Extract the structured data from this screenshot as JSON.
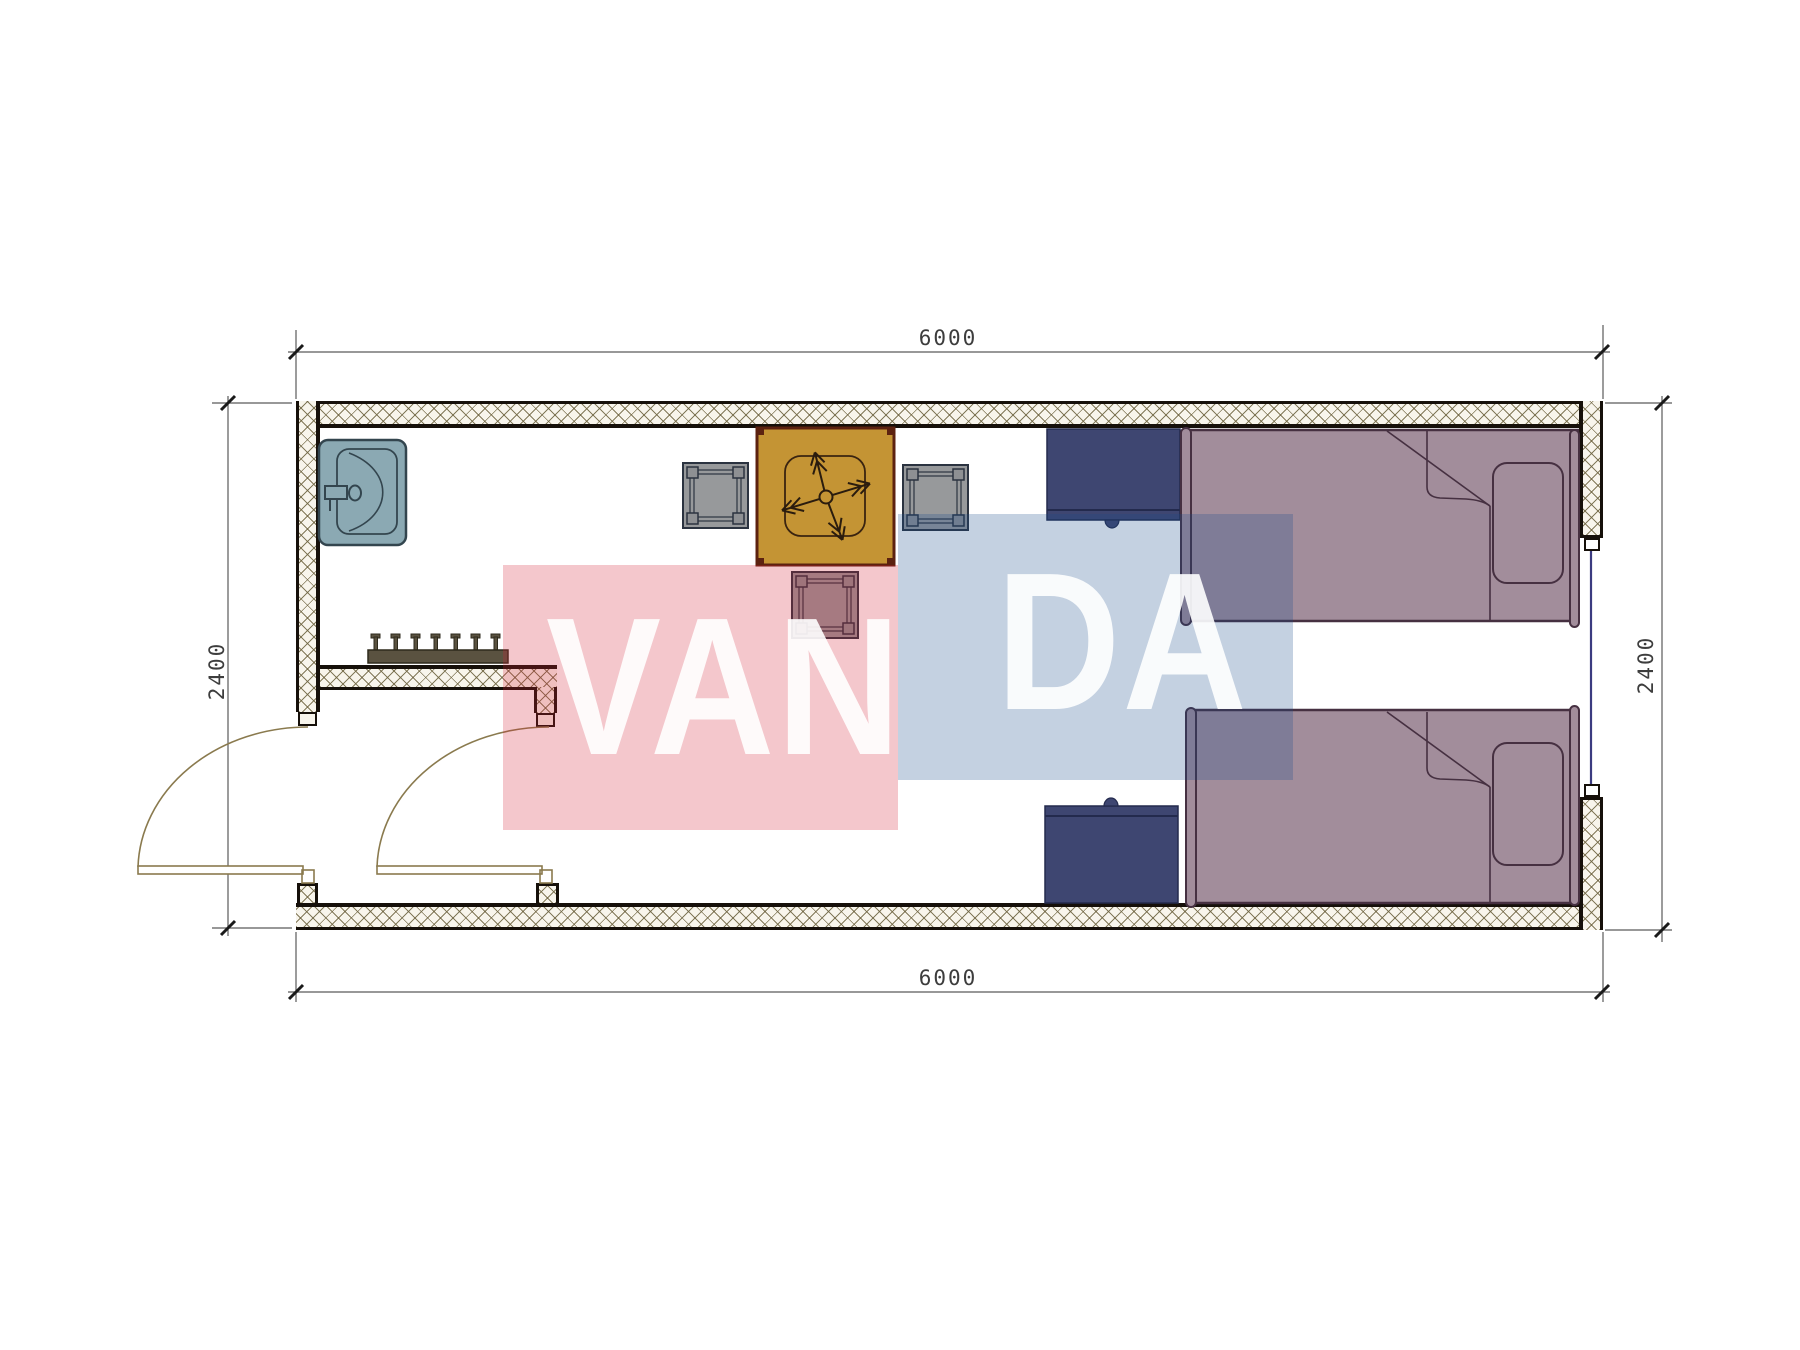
{
  "drawing": {
    "type": "floor-plan",
    "dimensions": {
      "top": "6000",
      "bottom": "6000",
      "left": "2400",
      "right": "2400"
    },
    "watermark": {
      "part1": "VAN",
      "part2": "DA",
      "full_text": "VANDA"
    }
  },
  "palette": {
    "wall-ink": "#16100a",
    "hatch-bg": "#f8f5ec",
    "hatch-line": "rgba(110,100,64,0.85)",
    "dim-line": "#5a5a5a",
    "tick-ink": "#1a1a1a",
    "door-line": "#8a7a4e",
    "window-line": "#3b3b80",
    "sink-fill": "#8ba9b3",
    "sink-ink": "#33454e",
    "table-fill": "#c49434",
    "table-ink": "#5c2210",
    "cross-ink": "#2a1c0e",
    "chair-fill": "#97999b",
    "chair-ink": "#2b3340",
    "desk-fill": "#3e4671",
    "desk-ink": "#232a4d",
    "bed-fill": "#a28d9b",
    "bed-ink": "#463041",
    "rack-fill": "#5a5240",
    "rack-ink": "#2e2a1c",
    "wm-pink": "rgba(213,30,50,0.25)",
    "wm-blue": "rgba(27,76,140,0.26)",
    "wm-text": "rgba(255,255,255,0.9)"
  }
}
